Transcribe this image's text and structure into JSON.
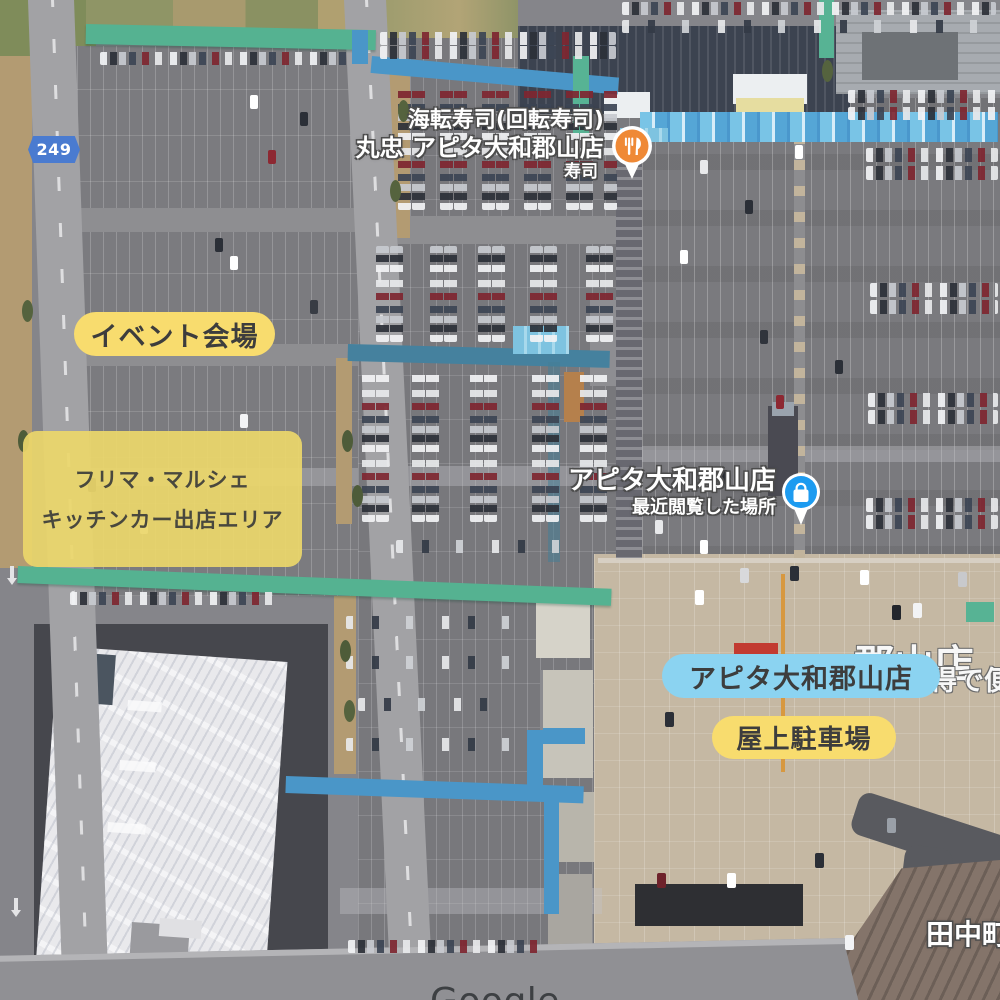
{
  "map": {
    "route_badge": "249",
    "attribution": "Google",
    "poi": {
      "sushi": {
        "line1": "海転寿司(回転寿司)",
        "line2": "丸忠 アピタ大和郡山店",
        "category": "寿司",
        "icon": "restaurant-pin"
      },
      "apita": {
        "name": "アピタ大和郡山店",
        "subtitle": "最近閲覧した場所",
        "icon": "shopping-bag-pin"
      },
      "district": "田中町",
      "rooftop_paint_fragment_main": "郡山店",
      "rooftop_paint_fragment_side": "得で便"
    },
    "annotations": {
      "event_venue": "イベント会場",
      "vendor_area_line1": "フリマ・マルシェ",
      "vendor_area_line2": "キッチンカー出店エリア",
      "store_name": "アピタ大和郡山店",
      "rooftop_parking": "屋上駐車場"
    },
    "colors": {
      "annotation_yellow": "#F8DC6E",
      "annotation_blue": "#8BD3F1",
      "route_badge_blue": "#4A7BD0",
      "restaurant_pin_orange": "#EF8936",
      "place_pin_blue": "#1D9BF0",
      "walkway_teal": "#55B291",
      "walkway_blue": "#4A96C8"
    }
  }
}
